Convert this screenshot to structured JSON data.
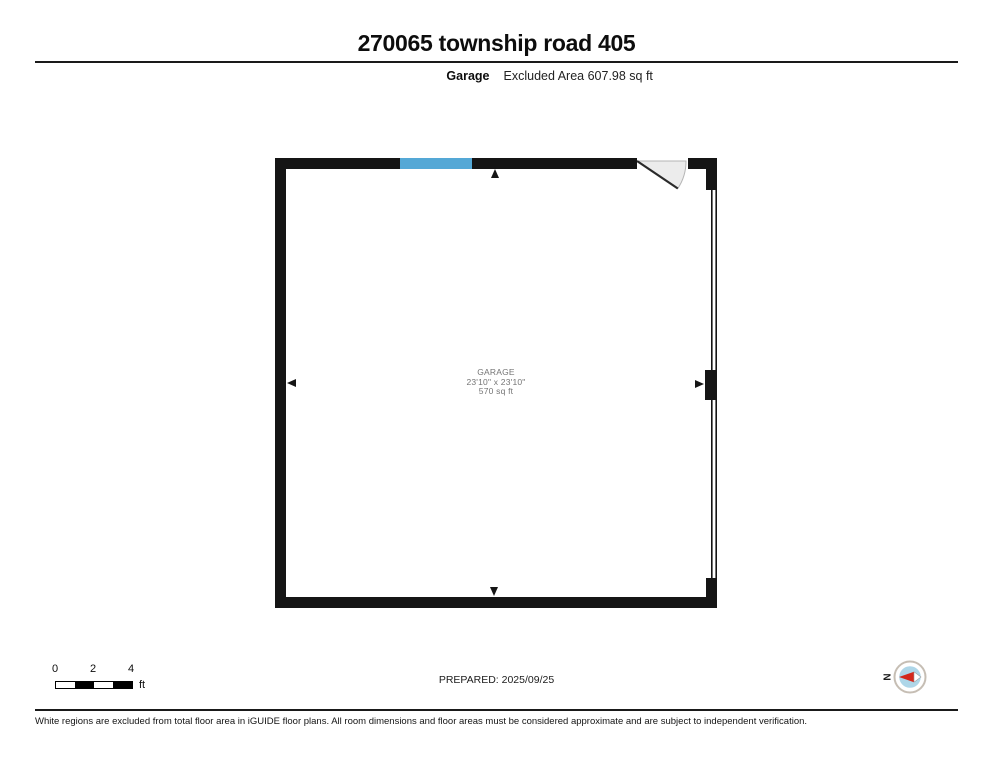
{
  "header": {
    "title": "270065 township road 405",
    "room_name": "Garage",
    "area_info": "Excluded Area 607.98 sq ft"
  },
  "plan": {
    "room_label": {
      "name": "GARAGE",
      "dimensions": "23'10\" x 23'10\"",
      "area": "570 sq ft"
    },
    "colors": {
      "wall": "#151515",
      "window": "#54a8d6",
      "door_fill": "#ececec",
      "door_arc_stroke": "#b5b5b5",
      "door_leaf": "#2a2a2a"
    }
  },
  "footer": {
    "scale": {
      "ticks": [
        "0",
        "2",
        "4"
      ],
      "unit": "ft"
    },
    "prepared": "PREPARED: 2025/09/25",
    "compass": {
      "letter": "N",
      "needle_color": "#d3281c",
      "face_color": "#aed6e8",
      "ring_color": "#c6beb4"
    },
    "disclaimer": "White regions are excluded from total floor area in iGUIDE floor plans. All room dimensions and floor areas must be considered approximate and are subject to independent verification."
  }
}
